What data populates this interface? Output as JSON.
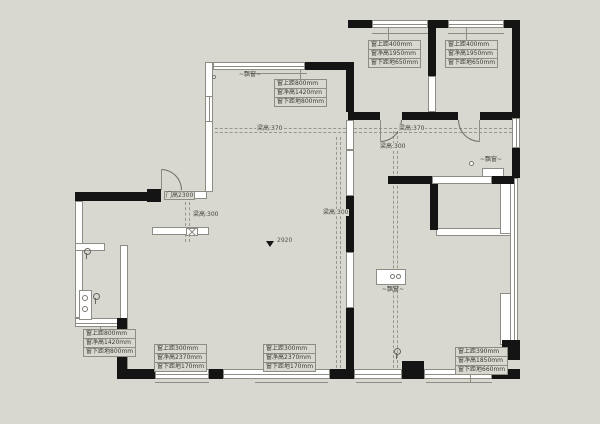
{
  "colors": {
    "background": "#d9d8d0",
    "wall": "#141414"
  },
  "window_annotations": [
    {
      "id": "bay-top",
      "lines": [
        "窗上距800mm",
        "窗净高1420mm",
        "窗下距地800mm"
      ]
    },
    {
      "id": "bedroom-left",
      "lines": [
        "窗上距400mm",
        "窗净高1950mm",
        "窗下距地650mm"
      ]
    },
    {
      "id": "bedroom-right",
      "lines": [
        "窗上距400mm",
        "窗净高1950mm",
        "窗下距地650mm"
      ]
    },
    {
      "id": "kitchen",
      "lines": [
        "窗上距800mm",
        "窗净高1420mm",
        "窗下距地800mm"
      ]
    },
    {
      "id": "bottom-left",
      "lines": [
        "窗上距300mm",
        "窗净高2370mm",
        "窗下距地170mm"
      ]
    },
    {
      "id": "bottom-middle",
      "lines": [
        "窗上距300mm",
        "窗净高2370mm",
        "窗下距地170mm"
      ]
    },
    {
      "id": "bottom-right",
      "lines": [
        "窗上距390mm",
        "窗净高1850mm",
        "窗下距地660mm"
      ]
    }
  ],
  "beam_labels": {
    "living_horizontal": "梁高:370",
    "hall_horizontal": "梁高:370",
    "hall_vertical": "梁高:300",
    "living_vertical": "梁高:300",
    "entry_vertical": "梁高:300"
  },
  "door_label": "门高2300",
  "level_marker": "2920",
  "bay_window_label": "~飘窗~"
}
